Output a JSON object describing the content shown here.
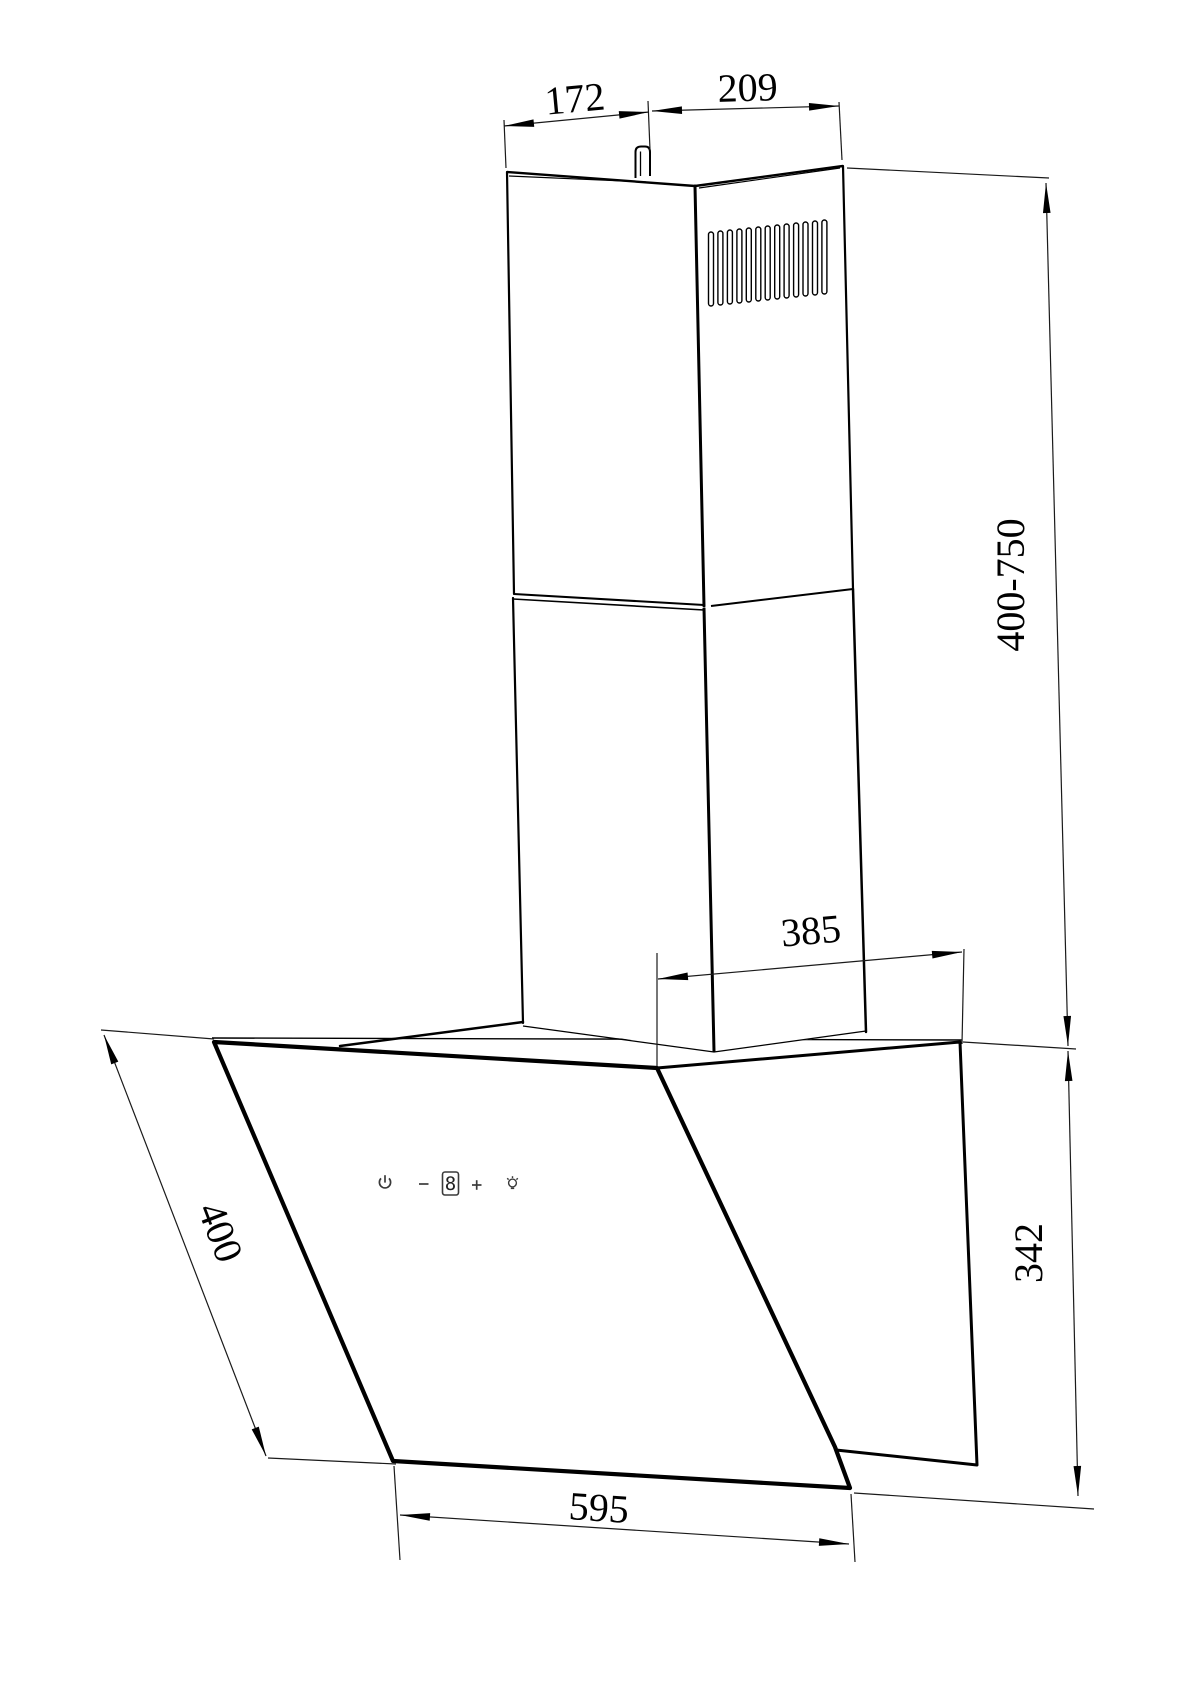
{
  "drawing": {
    "type": "cooker-hood-dimensional-drawing",
    "units_implied": "mm"
  },
  "dimensions": {
    "chimney_top_depth": "172",
    "chimney_top_width": "209",
    "chimney_height_range": "400-750",
    "chimney_rear_offset": "385",
    "glass_panel_depth": "400",
    "body_height": "342",
    "hood_width": "595"
  },
  "controls": {
    "display_value": "8",
    "icons": [
      "power",
      "minus",
      "speed-display",
      "plus",
      "light"
    ]
  },
  "colors": {
    "line": "#000000",
    "dimension_line": "#1a1a1a",
    "background": "#ffffff",
    "control_icon": "#3a3a3a"
  }
}
